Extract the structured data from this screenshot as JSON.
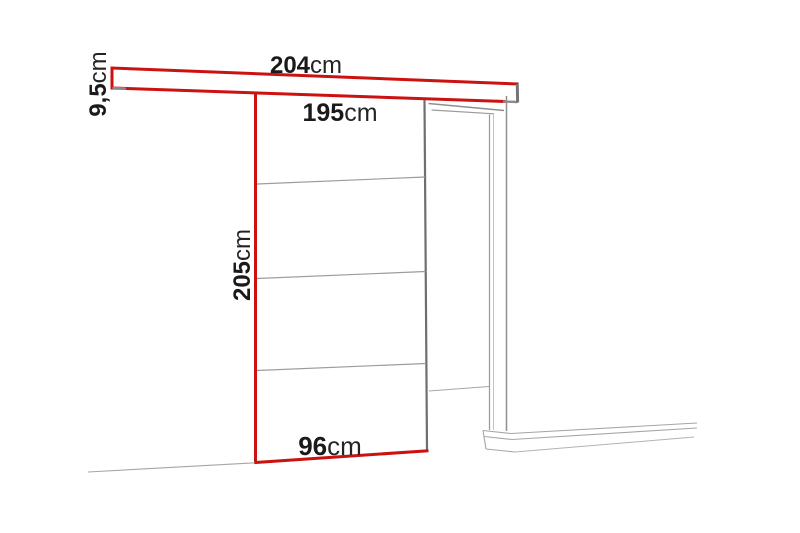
{
  "diagram": {
    "title": "Sliding door system dimension drawing",
    "colors": {
      "dimension_red": "#cc1111",
      "structure_gray": "#8f8f8f",
      "text": "#1a1a1a"
    },
    "labels": {
      "rail_length": {
        "value": "204",
        "unit": "cm"
      },
      "rail_height": {
        "value": "9,5",
        "unit": "cm"
      },
      "track_width": {
        "value": "195",
        "unit": "cm"
      },
      "door_height": {
        "value": "205",
        "unit": "cm"
      },
      "door_width": {
        "value": "96",
        "unit": "cm"
      }
    }
  }
}
